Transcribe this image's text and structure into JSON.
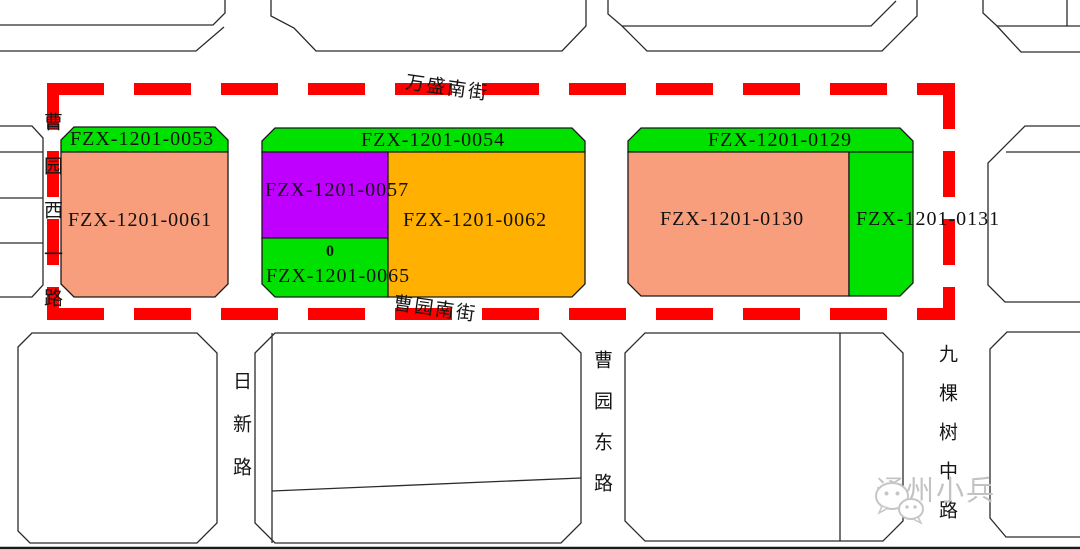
{
  "boundary": {
    "color": "#fe0000"
  },
  "outline": {
    "color": "#2b2b2b"
  },
  "streets": {
    "wansheng_south": "万盛南街",
    "caoyuan_south": "曹园南街",
    "caoyuan_west1": "曹园西一路",
    "rixin": "日新路",
    "caoyuan_east": "曹园东路",
    "jiukeshu_middle": "九棵树中路"
  },
  "parcels": [
    {
      "id": "FZX-1201-0053",
      "color": "#00e100"
    },
    {
      "id": "FZX-1201-0061",
      "color": "#f89e7c"
    },
    {
      "id": "FZX-1201-0054",
      "color": "#00e100"
    },
    {
      "id": "FZX-1201-0057",
      "color": "#bf00ff"
    },
    {
      "id": "FZX-1201-0062",
      "color": "#ffb000"
    },
    {
      "id": "FZX-1201-0065",
      "color": "#00e100",
      "note": "0"
    },
    {
      "id": "FZX-1201-0129",
      "color": "#00e100"
    },
    {
      "id": "FZX-1201-0130",
      "color": "#f89e7c"
    },
    {
      "id": "FZX-1201-0131",
      "color": "#00e100"
    }
  ],
  "watermark": {
    "text": "通州小兵"
  }
}
